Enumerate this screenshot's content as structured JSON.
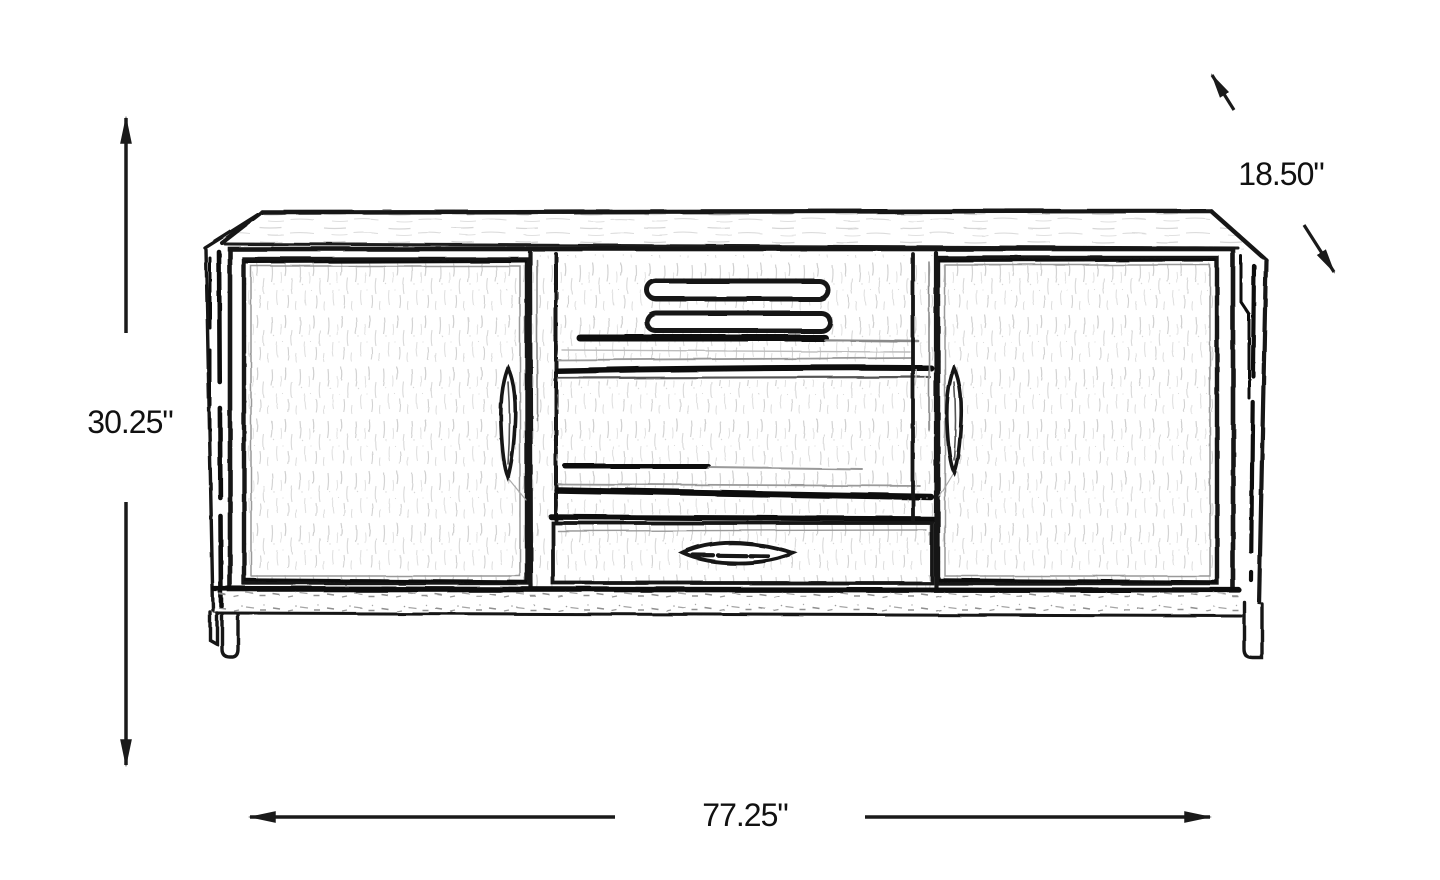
{
  "page": {
    "background": "#ffffff",
    "line_color": "#1a1a1a"
  },
  "diagram": {
    "type": "furniture-dimension-line-drawing",
    "subject": "media-console-cabinet-front-sketch",
    "dimensions": {
      "height_label": "30.25\"",
      "width_label": "77.25\"",
      "depth_label": "18.50\""
    }
  }
}
